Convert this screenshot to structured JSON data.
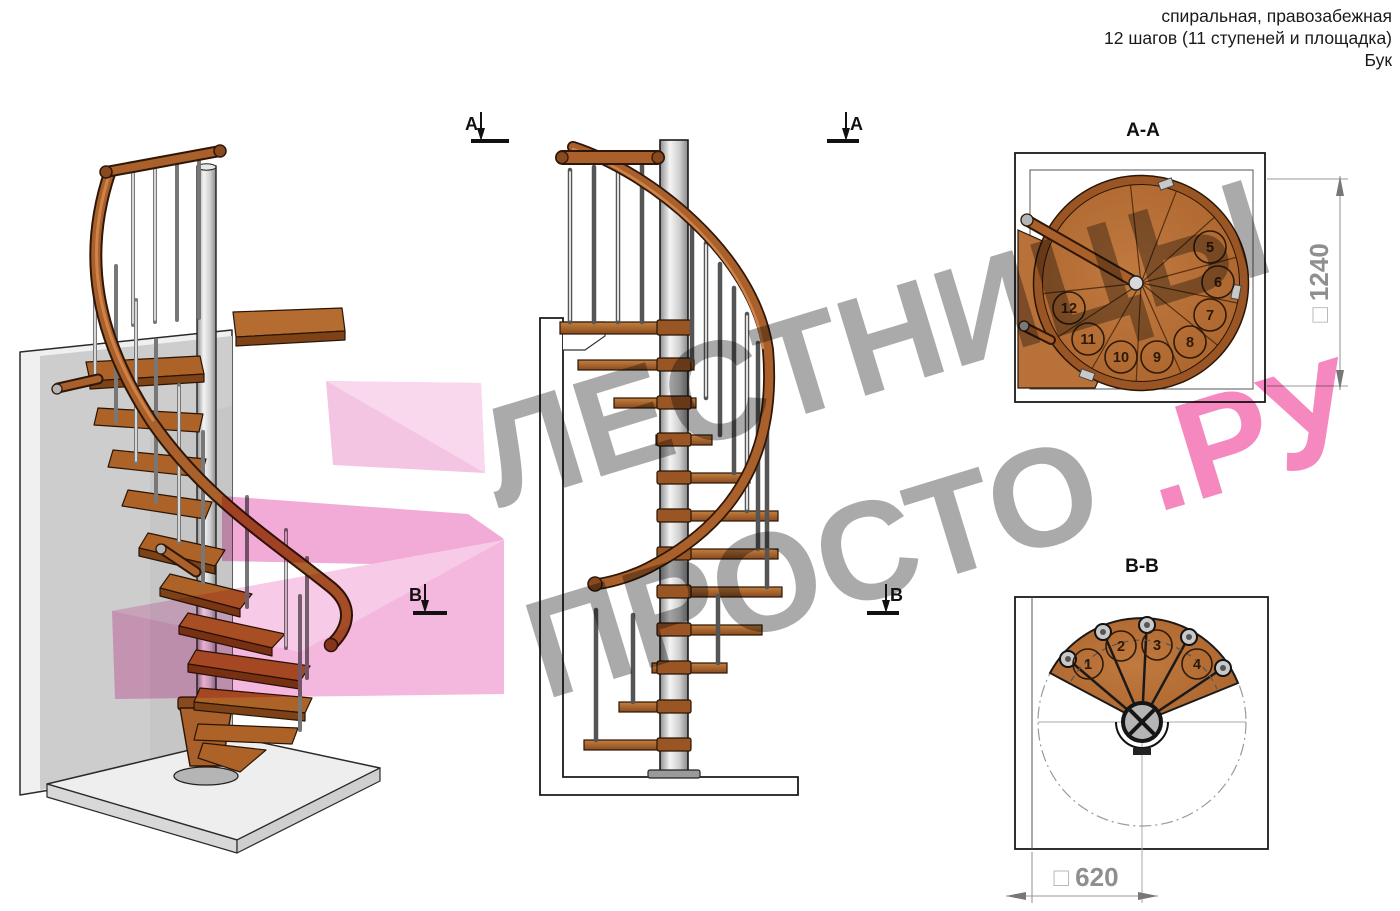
{
  "header": {
    "line1": "спиральная, правозабежная",
    "line2": "12 шагов (11 ступеней и площадка)",
    "line3": "Бук"
  },
  "watermark": {
    "word1": "ЛЕСТНИЦЫ",
    "word2": "ПРОСТО",
    "word3": ".РУ"
  },
  "markers": {
    "a": "A",
    "b": "B"
  },
  "sections": {
    "aa": {
      "label": "A-A",
      "dim_prefix": "□",
      "dim_value": "1240",
      "steps": [
        "5",
        "6",
        "7",
        "8",
        "9",
        "10",
        "11",
        "12"
      ]
    },
    "bb": {
      "label": "B-B",
      "dim_prefix": "□",
      "dim_value": "620",
      "steps": [
        "1",
        "2",
        "3",
        "4"
      ]
    }
  },
  "colors": {
    "wood": "#b9713a",
    "wood_dark": "#8a4a1f",
    "metal": "#d9d9d9",
    "watermark_gray": "#9e9e9e",
    "watermark_pink": "#f06fb2",
    "dim_gray": "#8f8f8f"
  }
}
